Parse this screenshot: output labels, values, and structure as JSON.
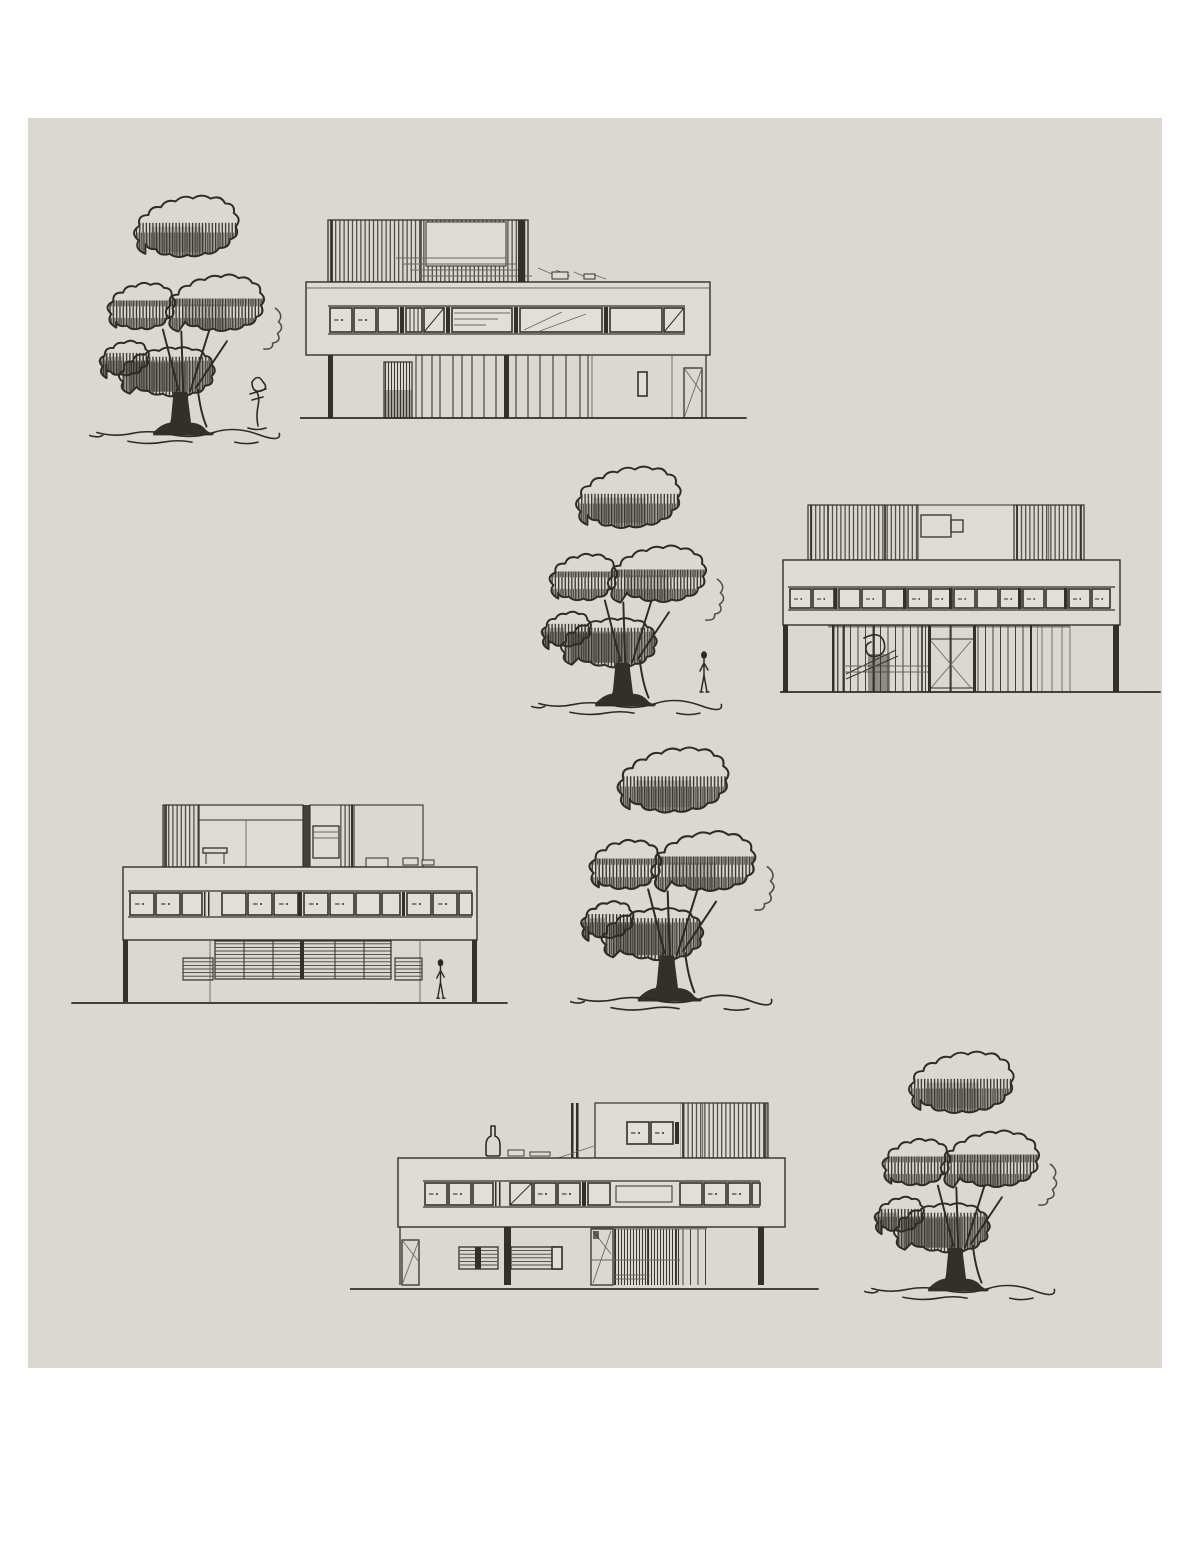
{
  "page": {
    "background_color": "#ffffff"
  },
  "panel": {
    "background_color": "#dbd8d2",
    "ink_color": "#33302a",
    "left": 28,
    "top": 118,
    "width": 1134,
    "height": 1250
  },
  "sketch": {
    "kind": "hand-drawn architectural elevation studies of a modernist villa with sketched trees",
    "rows": [
      {
        "items": [
          "tree-sketch",
          "sapling-sketch",
          "building-elevation"
        ],
        "building_position": "right"
      },
      {
        "items": [
          "tree-sketch",
          "person-sketch",
          "building-elevation"
        ],
        "building_position": "right"
      },
      {
        "items": [
          "building-elevation",
          "person-sketch",
          "tree-sketch"
        ],
        "building_position": "left"
      },
      {
        "items": [
          "building-elevation",
          "bottle-sketch",
          "tree-sketch"
        ],
        "building_position": "left"
      }
    ]
  }
}
